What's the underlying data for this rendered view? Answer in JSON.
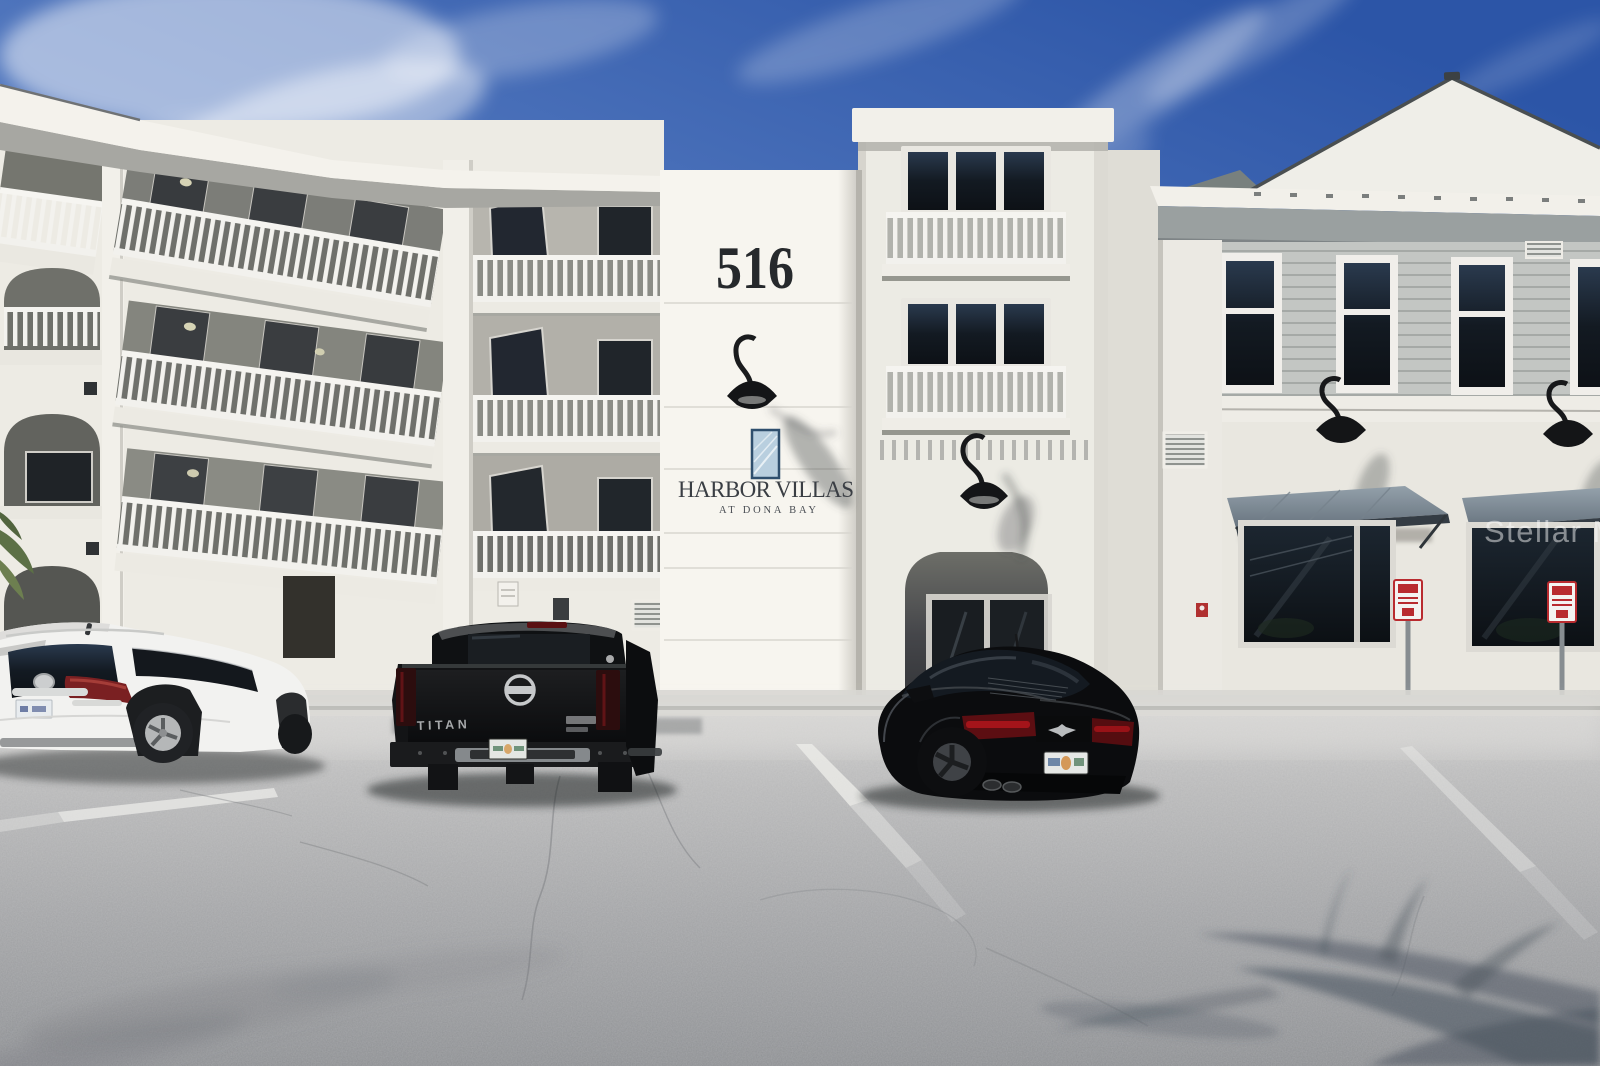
{
  "photo": {
    "watermark": "Stellar MLS",
    "building": {
      "address_number": "516",
      "name_sign": "HARBOR VILLAS",
      "subtitle_sign": "AT DONA BAY"
    },
    "vehicles": {
      "truck_tailgate_badge": "TITAN"
    },
    "colors": {
      "sky_top": "#2c55a7",
      "sky_bottom": "#93add9",
      "stucco_white": "#f7f5ef",
      "siding_gray": "#c3c6c3",
      "awning_slate": "#7f8b96",
      "logo_navy": "#2f4f6e",
      "logo_fill": "#b9cfdf",
      "taillight_red": "#a8151b",
      "asphalt_gray": "#a9aaac",
      "parking_sign_red": "#b92b2f"
    }
  }
}
